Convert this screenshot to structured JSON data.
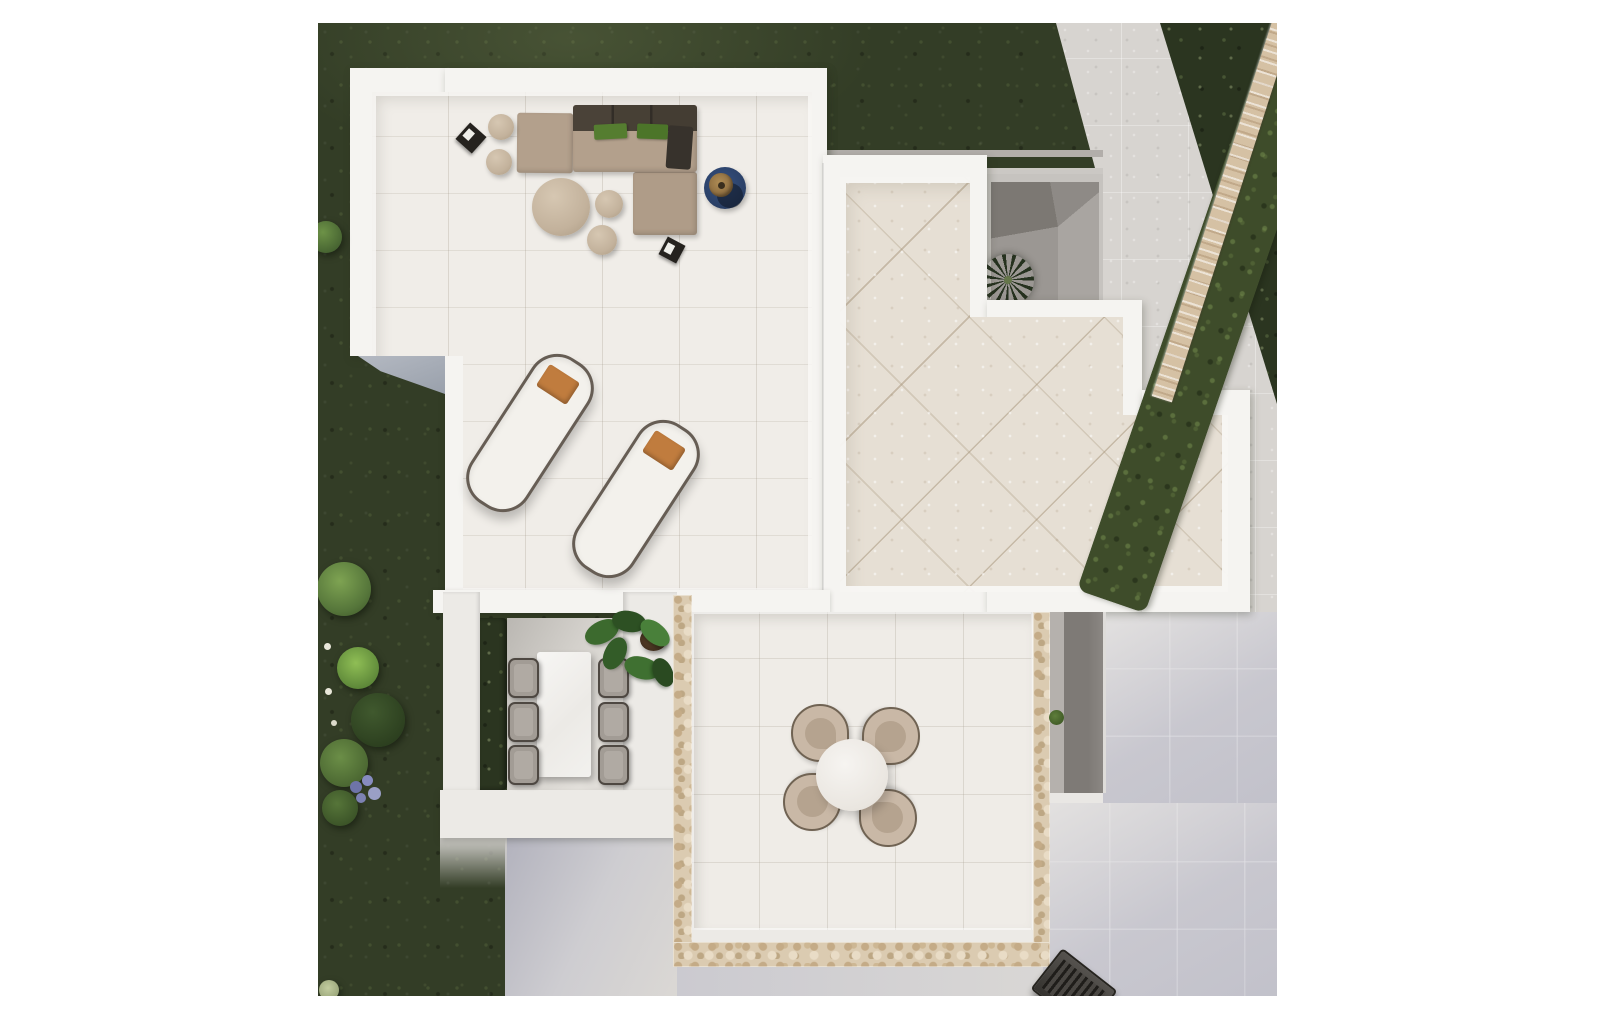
{
  "meta": {
    "type": "architectural-aerial-render",
    "description": "Top-down 3D architectural render of a modern white villa roof terrace with outdoor furniture, a stepped tiled upper terrace, a sunken dining patio, a round table set, surrounding dark green lawn, a diagonal boundary hedge with a natural stone wall, and light gray paving"
  },
  "colors": {
    "page_bg": "#ffffff",
    "grass": "#333d26",
    "grass_dark": "#2b3520",
    "hedge": "#3e4c2a",
    "wall_stone": "#d5c1a4",
    "parapet": "#f5f4f1",
    "tile_lounge": "#f0ede8",
    "tile_upper": "#e6dfd4",
    "tile_lower": "#efece7",
    "paving": "#d7d4d0",
    "paving_cool": "#c9c8cf",
    "stone": "#dbcbb1",
    "courtyard": "#c6c3bf",
    "courtyard_dark": "#817d78",
    "patio_wall": "#eceae6",
    "taupe": "#b3a08c",
    "sofa_back": "#4a4238",
    "pillow_green": "#557d30",
    "throw_dark": "#37322c",
    "rug_blue": "#2c4269",
    "pillow_orange": "#c07c3e",
    "lounger": "#f3f1ec",
    "table_white": "#f3f2ef",
    "chair_shell": "#c9b8a6",
    "chair_gray": "#a29c95",
    "plant_green": "#3c6a2e",
    "palm": "#26341e",
    "bbq": "#3f3c38",
    "bush_bright": "#8fbe55",
    "bush_mid": "#5d7f3e",
    "bush_dark": "#3c5429",
    "flower_white": "#e9e7da",
    "flower_purple": "#878cc0"
  },
  "scene": {
    "areas": [
      {
        "name": "lounge-roof-terrace",
        "label": "Roof terrace with outdoor sofa set and sun loungers"
      },
      {
        "name": "upper-right-terrace",
        "label": "Stepped terrace with diagonal beige tiles"
      },
      {
        "name": "courtyard-lightwell",
        "label": "Sunken courtyard with palm tree"
      },
      {
        "name": "dining-patio",
        "label": "Sunken dining patio with table for six"
      },
      {
        "name": "lower-terrace",
        "label": "Stone-edged terrace with round table for four"
      },
      {
        "name": "garden",
        "label": "Dark green lawn with shrubs and flowers"
      },
      {
        "name": "boundary",
        "label": "Diagonal hedge and natural stone boundary wall"
      },
      {
        "name": "paving",
        "label": "Light gray tiled ground paving"
      }
    ],
    "furniture": [
      {
        "name": "outdoor-sofa",
        "label": "L-shaped taupe outdoor sofa with dark back cushions, two green pillows and a dark throw"
      },
      {
        "name": "coffee-table",
        "label": "Large round taupe coffee table with side poufs"
      },
      {
        "name": "round-rug",
        "label": "Round dark blue rug with potted plant"
      },
      {
        "name": "sun-loungers",
        "label": "Two white sun loungers with orange pillows, count 2"
      },
      {
        "name": "dining-table",
        "label": "White rectangular dining table with six gray chairs"
      },
      {
        "name": "round-table-set",
        "label": "Round white table with four shell chairs"
      },
      {
        "name": "bbq-grill",
        "label": "Dark grill unit at bottom edge"
      }
    ]
  }
}
